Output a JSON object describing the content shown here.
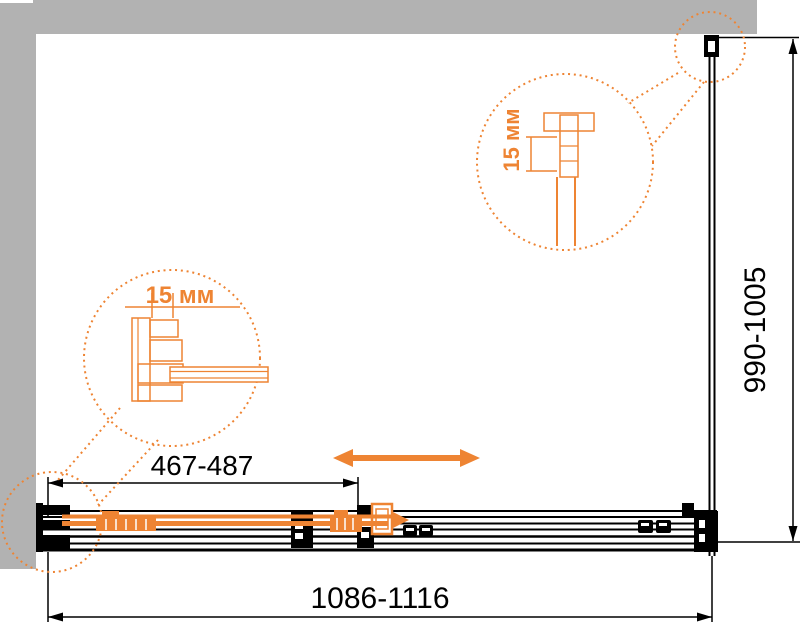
{
  "diagram": {
    "bottom_width_label": "1086-1116",
    "door_width_label": "467-487",
    "side_depth_label": "990-1005",
    "left_detail_label": "15 мм",
    "top_detail_label": "15 мм"
  },
  "colors": {
    "accent_orange": "#ee8433",
    "backdrop_gray": "#b2b2b2",
    "line_black": "#000000",
    "page_background": "#ffffff"
  }
}
